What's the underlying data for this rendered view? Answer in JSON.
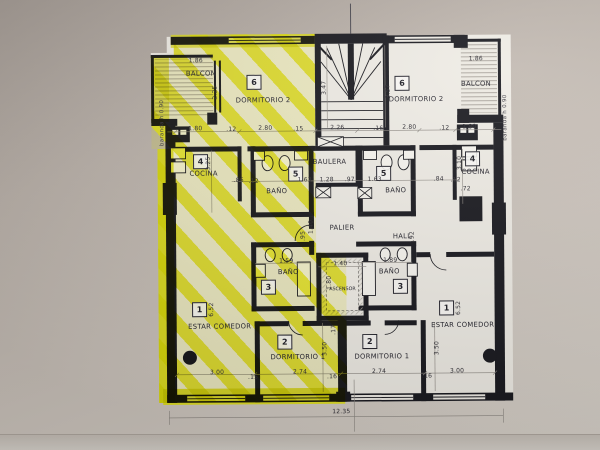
{
  "photo": {
    "paper_color": "#c9c1b9",
    "plan_paper": "#efece5",
    "line_color": "#1c1c22",
    "highlight_color": "#e6e600"
  },
  "rooms": {
    "balcon_left": {
      "label": "BALCON"
    },
    "balcon_right": {
      "label": "BALCON"
    },
    "baranda_left": {
      "label": "baranda h 0.90"
    },
    "baranda_right": {
      "label": "baranda h 0.90"
    },
    "dorm2_left": {
      "number": "6",
      "label": "DORMITORIO 2"
    },
    "dorm2_right": {
      "number": "6",
      "label": "DORMITORIO 2"
    },
    "cocina_left": {
      "number": "4",
      "label": "COCINA"
    },
    "cocina_right": {
      "number": "4",
      "label": "COCINA"
    },
    "bath_upper_left": {
      "number": "5",
      "label": "BAÑO"
    },
    "bath_upper_right": {
      "number": "5",
      "label": "BAÑO"
    },
    "bath_lower_left": {
      "number": "3",
      "label": "BAÑO"
    },
    "bath_lower_right": {
      "number": "3",
      "label": "BAÑO"
    },
    "estar_left": {
      "number": "1",
      "label": "ESTAR COMEDOR"
    },
    "estar_right": {
      "number": "1",
      "label": "ESTAR COMEDOR"
    },
    "dorm1_left": {
      "number": "2",
      "label": "DORMITORIO 1"
    },
    "dorm1_right": {
      "number": "2",
      "label": "DORMITORIO 1"
    },
    "baulera": {
      "label": "BAULERA"
    },
    "palier": {
      "label": "PALIER"
    },
    "ascensor": {
      "label": "ASCENSOR"
    },
    "hall": {
      "label": "HALL"
    }
  },
  "dims": {
    "top_row": [
      "1.80",
      ".12",
      "2.80",
      ".15",
      "2.26",
      ".16",
      "2.80",
      ".12",
      "1.80"
    ],
    "balcony_width_left": "1.86",
    "balcony_width_right": "1.86",
    "balcony_depth": "2.25",
    "stair_left": "3.47",
    "stair_right": "3.57",
    "mid_row": [
      ".86",
      ".12",
      "1.63",
      "1.28",
      ".97",
      "1.63",
      ".84",
      ".12"
    ],
    "cocina_left_v": "3.25",
    "cocina_right_v": "3.10",
    "cocina_right_w": ".72",
    "palier_v": "1.40",
    "ascensor_w": "1.40",
    "ascensor_h": "1.80",
    "bath_left_w": "1.59",
    "bath_right_w": "1.89",
    "bath_left_v": ".95",
    "hall_v": ".92",
    "pass_v": ".17",
    "estar_left_v": "6.52",
    "estar_right_v": "6.52",
    "dorm1_left_v": "3.50",
    "dorm1_right_v": "3.50",
    "bottom_row": [
      "3.00",
      ".15",
      "2.74",
      ".16",
      "2.74",
      ".16",
      "3.00"
    ],
    "total_width": "12.35"
  }
}
